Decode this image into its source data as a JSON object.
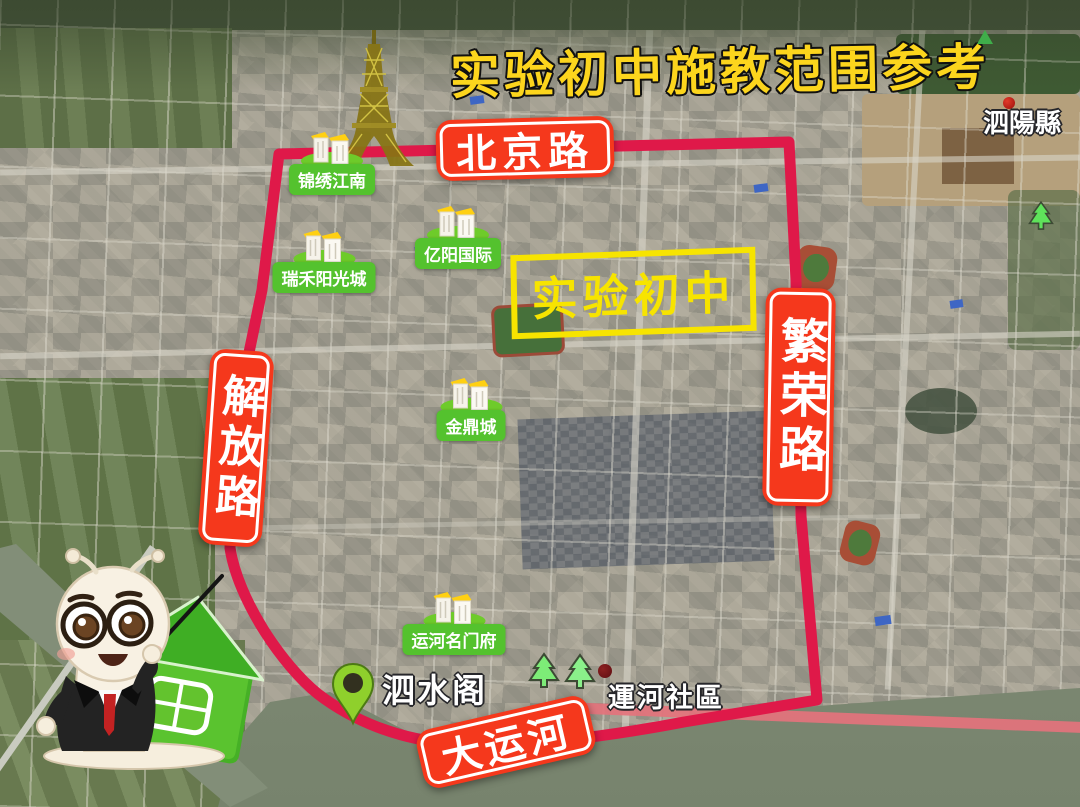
{
  "title": "实验初中施教范围参考",
  "roads": {
    "beijing_road": "北京路",
    "jiefang_road": "解放路",
    "fanrong_road": "繁荣路",
    "grand_canal": "大运河"
  },
  "school": {
    "name": "实验初中"
  },
  "communities": [
    {
      "name": "锦绣江南"
    },
    {
      "name": "瑞禾阳光城"
    },
    {
      "name": "亿阳国际"
    },
    {
      "name": "金鼎城"
    },
    {
      "name": "运河名门府"
    }
  ],
  "places": [
    {
      "name": "泗陽縣",
      "marker": "red-dot"
    },
    {
      "name": "泗水阁",
      "marker": "green-pin"
    },
    {
      "name": "運河社區",
      "marker": "dark-red-dot"
    }
  ],
  "colors": {
    "boundary_line": "#df1949",
    "road_label_bg": "#f5381c",
    "community_label_bg": "#54c22e",
    "school_label": "#f7e400",
    "title_text": "#fcd51d",
    "river_bank": "#e4737c"
  }
}
